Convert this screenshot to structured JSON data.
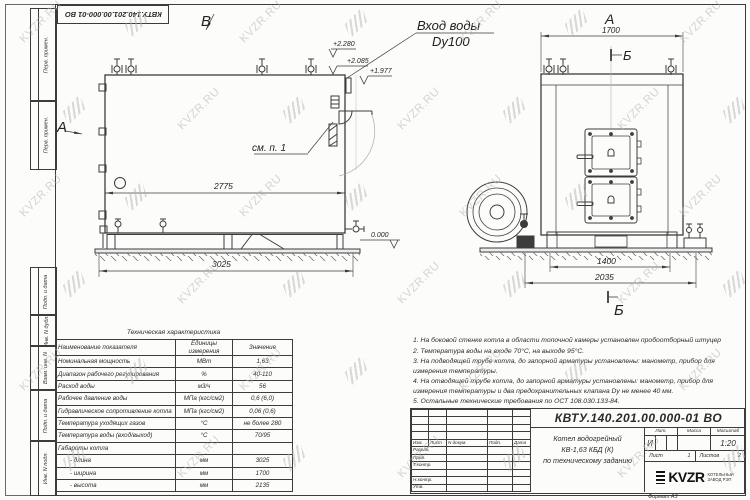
{
  "watermark": {
    "text": "KVZR.RU"
  },
  "frame": {
    "doc_number_top": "КВТУ.140.201.00.000-01 ВО",
    "margin_labels": [
      "Перв. примен.",
      "Перв. примен.",
      "Подп. и дата",
      "Инв. N дубл.",
      "Взам. инв. N",
      "Подп. и дата",
      "Инв. N подл."
    ]
  },
  "views": {
    "front": {
      "label_b": "В",
      "label_a": "А",
      "see_note": "см. п. 1",
      "inlet1": "Вход воды",
      "inlet2": "Dy100",
      "e1": "+2.280",
      "e2": "+2.085",
      "e3": "+1.977",
      "zero": "0.000",
      "dim_inner": "2775",
      "dim_base": "3025"
    },
    "side": {
      "label_a": "А",
      "b_top": "Б",
      "b_bottom": "Б",
      "dim_width": "1700",
      "dim_inner": "1400",
      "dim_outer": "2035"
    }
  },
  "tech_table": {
    "title": "Техническая характеристика",
    "headers": [
      "Наименование показателя",
      "Единицы измерения",
      "Значение"
    ],
    "rows": [
      {
        "name": "Номинальная мощность",
        "unit": "МВт",
        "value": "1,63"
      },
      {
        "name": "Диапазон рабочего регулирования",
        "unit": "%",
        "value": "40-110"
      },
      {
        "name": "Расход воды",
        "unit": "м3/ч",
        "value": "56"
      },
      {
        "name": "Рабочее давление воды",
        "unit": "МПа (кгс/см2)",
        "value": "0,6 (6,0)"
      },
      {
        "name": "Гидравлическое сопротивление котла",
        "unit": "МПа (кгс/см2)",
        "value": "0,06 (0,6)"
      },
      {
        "name": "Температура уходящих газов",
        "unit": "°С",
        "value": "не более 280"
      },
      {
        "name": "Температура воды (вход/выход)",
        "unit": "°С",
        "value": "70/95"
      },
      {
        "name": "Габариты котла",
        "unit": "",
        "value": ""
      },
      {
        "name": "- длина",
        "unit": "мм",
        "value": "3025"
      },
      {
        "name": "- ширина",
        "unit": "мм",
        "value": "1700"
      },
      {
        "name": "- высота",
        "unit": "мм",
        "value": "2135"
      }
    ]
  },
  "notes": {
    "items": [
      "1.  На боковой стенке котла в области топочной камеры установлен пробоотборный штуцер",
      "2.  Температура воды на входе 70°С, на выходе 95°С.",
      "3.  На подводящей трубе котла, до запорной арматуры установлены: манометр, прибор для измерения температуры.",
      "4.  На отводящей трубе котла, до запорной арматуры установлены: манометр, прибор для измерения температуры и два предохранительных клапана Dу не менее 40 мм.",
      "5.  Остальные технические требования по ОСТ 108.030.133-84."
    ]
  },
  "title_block": {
    "doc_number": "КВТУ.140.201.00.000-01 ВО",
    "rev_headers": [
      "Изм.",
      "Лист",
      "N докум.",
      "Подп.",
      "Дата"
    ],
    "row_labels": [
      "Разраб.",
      "Пров.",
      "Т.контр.",
      "",
      "Н.контр.",
      "Утв."
    ],
    "name_line1": "Котел водогрейный",
    "name_line2": "КВ-1,63 КБД (К)",
    "name_line3": "по техническому заданию",
    "lit_header": "Лит.",
    "mass_header": "Масса",
    "scale_header": "Масштаб",
    "lit_value": "И",
    "scale_value": "1:20",
    "sheet_label": "Лист",
    "sheet_value": "1",
    "sheets_label": "Листов",
    "sheets_value": "2",
    "logo_text": "KVZR",
    "logo_sub1": "КОТЕЛЬНЫЙ",
    "logo_sub2": "ЗАВОД РЭП",
    "format_label": "Формат  А3"
  }
}
